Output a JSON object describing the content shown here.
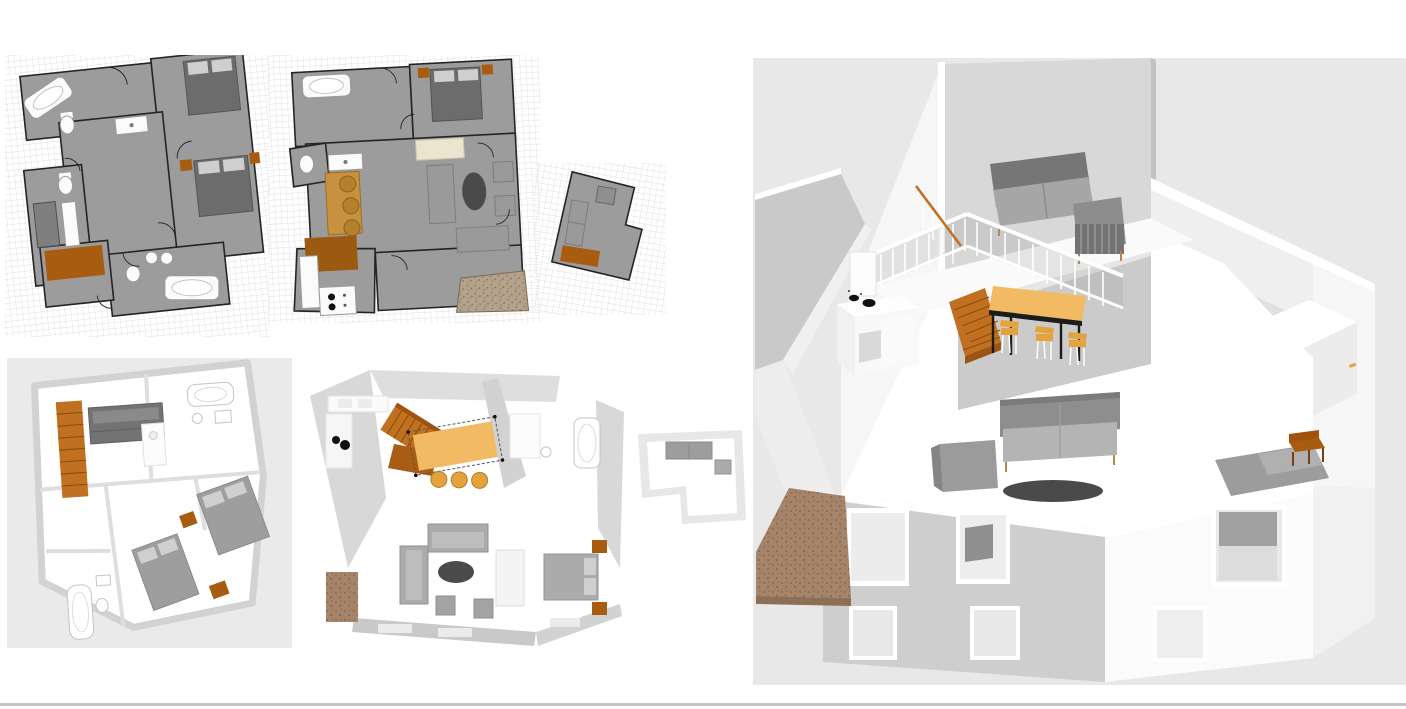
{
  "page": {
    "background": "#ffffff",
    "description": "Collage of home-design renders: two 2D floor plans with grid, three 3D top-down floor renders, one large 3D cutaway perspective of the house interior",
    "visible_text": "none"
  },
  "palette": {
    "grid_line": "#d7d7d7",
    "plan_floor_gray": "#9c9c9c",
    "plan_wall": "#242424",
    "bed_dark": "#6c6c6c",
    "furn_mid": "#9a9a9a",
    "furn_light": "#bdbdbd",
    "accent_orange": "#a85c10",
    "rug_brown": "#9c5a10",
    "stair_orange": "#c0701e",
    "stair_step": "#8a4d12",
    "table_tan": "#f2bb63",
    "chair_orange": "#e3a23b",
    "cream": "#ece4cf",
    "oval_dark": "#4a4a4a",
    "terrace_brown": "#a5846a",
    "terrace_dot": "#8a6a50",
    "terrace2_brown": "#b3a28c",
    "terrace2_dot": "#8f7a62",
    "render_bg": "#e8e8e8",
    "render_bg_light": "#eaeaea",
    "window_edge": "#c9c6c1"
  },
  "panels": [
    {
      "id": "plan2d-upper",
      "kind": "2d-floor-plan",
      "label": "2D floor plan - upper floor",
      "objects": [
        "grid",
        "bathtub",
        "toilet",
        "sink",
        "shower-closet",
        "double-bed",
        "double-bed",
        "orange-nightstands",
        "orange-rug",
        "bathroom-tub",
        "twin-sinks",
        "door-swings"
      ]
    },
    {
      "id": "plan2d-ground",
      "kind": "2d-floor-plan",
      "label": "2D floor plan - ground floor",
      "objects": [
        "grid",
        "bathtub",
        "toilet",
        "sink",
        "double-bed",
        "wardrobe",
        "sofa",
        "armchairs",
        "oval-coffee-table",
        "loveseat",
        "dining-table",
        "dining-chairs",
        "brown-rug",
        "kitchen-stove",
        "terrace"
      ]
    },
    {
      "id": "plan2d-annex",
      "kind": "2d-floor-plan",
      "label": "2D floor plan - annex room",
      "objects": [
        "grid",
        "sofa",
        "side-table",
        "orange-rug"
      ]
    },
    {
      "id": "plan3d-upper",
      "kind": "3d-top-view",
      "label": "3D top view - upper floor",
      "objects": [
        "orange-staircase",
        "bunk-bed",
        "bathtub",
        "washer",
        "double-bed",
        "double-bed",
        "orange-rugs",
        "bathroom-tub",
        "toilet"
      ]
    },
    {
      "id": "plan3d-ground",
      "kind": "3d-top-view",
      "label": "3D top view - ground floor",
      "objects": [
        "kitchen-counter",
        "cooktop-burners",
        "orange-staircase",
        "selected-dining-table",
        "stools",
        "bathtub",
        "sofa",
        "sofa",
        "oval-rug",
        "ottomans",
        "double-bed",
        "orange-nightstands",
        "terrace"
      ]
    },
    {
      "id": "plan3d-annex",
      "kind": "3d-top-view",
      "label": "3D top view - annex room",
      "objects": [
        "sofa",
        "side-table"
      ]
    },
    {
      "id": "view3d",
      "kind": "3d-perspective",
      "label": "3D perspective view - house interior cutaway",
      "objects": [
        "mezzanine-sofa",
        "mezzanine-armchair",
        "white-balustrade-railing",
        "orange-staircase",
        "stair-handrail",
        "dining-table",
        "dining-chairs",
        "kitchen-cabinet",
        "cooktop-burners",
        "living-sofa",
        "living-armchair",
        "round-rug",
        "bedroom-bed",
        "orange-desk",
        "front-wall-windows",
        "terrace-deck"
      ]
    }
  ]
}
